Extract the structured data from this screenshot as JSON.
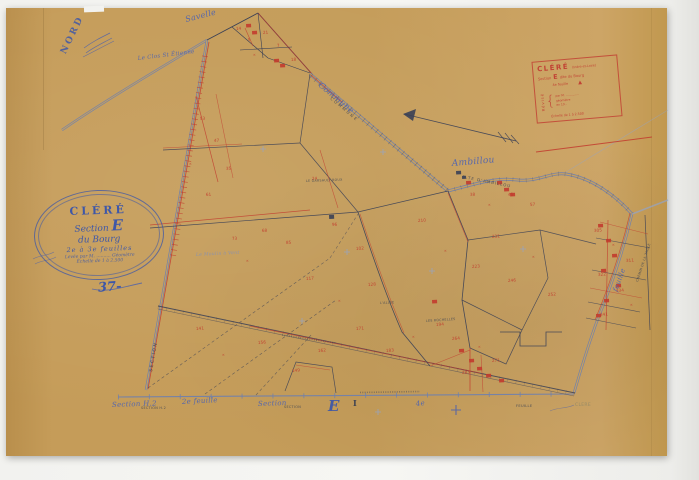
{
  "document": {
    "type": "cadastral-plan-scan",
    "commune": "CLÉRÉ",
    "section": "E"
  },
  "palette": {
    "paper": "#c9a15e",
    "blue": "#6e80ae",
    "blue_light": "#93a4c8",
    "ink": "#3a4056",
    "red": "#c23b2e",
    "stampblue": "#4a5fae",
    "label_script": "#5064b0",
    "label_caps": "#3a4254",
    "faded": "#8a8466"
  },
  "stamps": {
    "nord": {
      "label": "NORD"
    },
    "oval": {
      "title": "CLÉRÉ",
      "section_word": "Section",
      "section_letter": "E",
      "line3": "du Bourg",
      "line4": "2e à 3e feuilles",
      "line5": "Levée par M. .......... Géomètre",
      "line6": "Échelle de 1 à 2.500",
      "number": "37-"
    },
    "red_box": {
      "title": "CLÉRÉ",
      "subtitle": "(Indre-et-Loire)",
      "section_word": "Section",
      "section_letter": "E",
      "section_suffix": "dite du Bourg",
      "sheet_line": "4e feuille",
      "triangle": "▲",
      "left_word": "Révisé",
      "r1": "par M. ..............",
      "r2": "géomètre",
      "r3": "en 19..",
      "bottom": "Échelle de 1 à 2.500"
    }
  },
  "map_labels": [
    {
      "t": "Savelle",
      "x": 186,
      "y": 22,
      "r": -14,
      "s": 8,
      "cls": "script"
    },
    {
      "t": "Le Clos St Étienne",
      "x": 138,
      "y": 60,
      "r": -7,
      "s": 5.5,
      "cls": "script"
    },
    {
      "t": "Commune",
      "x": 318,
      "y": 86,
      "r": 40,
      "s": 8,
      "cls": "script"
    },
    {
      "t": "COMMUNE",
      "x": 330,
      "y": 99,
      "r": 40,
      "s": 4,
      "cls": "caps",
      "ls": 2
    },
    {
      "t": "Ambillou",
      "x": 452,
      "y": 166,
      "r": -5,
      "s": 9,
      "cls": "script"
    },
    {
      "t": "R.TE D'AMBILLOU",
      "x": 462,
      "y": 178,
      "r": 11,
      "s": 4,
      "cls": "caps",
      "ls": 1
    },
    {
      "t": "feuille",
      "x": 617,
      "y": 292,
      "r": -70,
      "s": 7,
      "cls": "script"
    },
    {
      "t": "CHEMIN DE LA TAILLE",
      "x": 638,
      "y": 282,
      "r": -72,
      "s": 3.2,
      "cls": "caps"
    },
    {
      "t": "SECTION",
      "x": 152,
      "y": 372,
      "r": -80,
      "s": 4.5,
      "cls": "caps",
      "ls": 1.5
    },
    {
      "t": "Section H.2",
      "x": 112,
      "y": 407,
      "r": -2,
      "s": 7,
      "cls": "script"
    },
    {
      "t": "SECTION H.2",
      "x": 141,
      "y": 409,
      "r": 0,
      "s": 3.4,
      "cls": "caps"
    },
    {
      "t": "2e feuille",
      "x": 182,
      "y": 404,
      "r": -3,
      "s": 7,
      "cls": "script"
    },
    {
      "t": "Section",
      "x": 258,
      "y": 406,
      "r": -2,
      "s": 7,
      "cls": "script"
    },
    {
      "t": "SECTION",
      "x": 284,
      "y": 408,
      "r": 0,
      "s": 3.4,
      "cls": "caps"
    },
    {
      "t": "E",
      "x": 328,
      "y": 411,
      "r": 0,
      "s": 15,
      "cls": "bigblue"
    },
    {
      "t": "I",
      "x": 353,
      "y": 406,
      "r": 0,
      "s": 8,
      "cls": "darkserif"
    },
    {
      "t": "4e",
      "x": 416,
      "y": 406,
      "r": -6,
      "s": 7,
      "cls": "script"
    },
    {
      "t": "FEUILLE",
      "x": 516,
      "y": 407,
      "r": 0,
      "s": 3.6,
      "cls": "caps"
    },
    {
      "t": "CLERE",
      "x": 575,
      "y": 406,
      "r": 0,
      "s": 4.5,
      "cls": "capsfaded"
    },
    {
      "t": "LE GARSAULT ROUX",
      "x": 306,
      "y": 182,
      "r": -2,
      "s": 3.2,
      "cls": "caps"
    },
    {
      "t": "Le Moulin à Vent",
      "x": 196,
      "y": 256,
      "r": -3,
      "s": 4.5,
      "cls": "scriptfaint"
    },
    {
      "t": "LES ROCHELLES",
      "x": 426,
      "y": 322,
      "r": -4,
      "s": 3.2,
      "cls": "caps"
    },
    {
      "t": "L'ALLÉE",
      "x": 380,
      "y": 304,
      "r": -3,
      "s": 3.2,
      "cls": "caps"
    }
  ],
  "map": {
    "strokes": [
      {
        "d": "M62,130 C100,104 150,74 207,40",
        "c": "blue",
        "w": 2.4,
        "o": 0.9
      },
      {
        "d": "M62,130 C100,104 150,74 207,40",
        "c": "paper",
        "w": 1
      },
      {
        "d": "M207,40 L146,390",
        "c": "blue",
        "w": 2.4,
        "o": 0.95
      },
      {
        "d": "M207,40 L146,390",
        "c": "paper",
        "w": 1
      },
      {
        "d": "M209,42 L148,389",
        "c": "red",
        "w": 0.8,
        "o": 0.85
      },
      {
        "d": "M205,56 L173,256",
        "c": "red",
        "w": 6,
        "dash": "0.7 4.6",
        "o": 0.7
      },
      {
        "d": "M207,40 L258,13",
        "c": "ink",
        "w": 0.9
      },
      {
        "d": "M258,13 L312,74",
        "c": "ink",
        "w": 0.9
      },
      {
        "d": "M258,13 L312,74",
        "c": "red",
        "w": 0.7,
        "o": 0.8
      },
      {
        "d": "M232,27 L268,58",
        "c": "ink",
        "w": 0.6
      },
      {
        "d": "M258,13 L263,58",
        "c": "ink",
        "w": 0.6
      },
      {
        "d": "M240,50 L292,47",
        "c": "ink",
        "w": 0.6
      },
      {
        "d": "M268,58 L310,73",
        "c": "ink",
        "w": 0.6
      },
      {
        "d": "M245,28 L253,46",
        "c": "red",
        "w": 0.6,
        "o": 0.8
      },
      {
        "d": "M310,74 L448,191",
        "c": "blue",
        "w": 3.2,
        "o": 0.85
      },
      {
        "d": "M310,74 L448,191",
        "c": "paper",
        "w": 1.5
      },
      {
        "d": "M311,76 L447,190",
        "c": "ink",
        "w": 5,
        "dash": "0.7 5",
        "o": 0.4
      },
      {
        "d": "M311,75 L342,102",
        "c": "red",
        "w": 0.8,
        "o": 0.8
      },
      {
        "d": "M448,191 C475,184 495,177 518,180 C538,182 550,172 566,174 C592,178 616,196 632,214",
        "c": "blue",
        "w": 3,
        "o": 0.9
      },
      {
        "d": "M448,191 C475,184 495,177 518,180 C538,182 550,172 566,174 C592,178 616,196 632,214",
        "c": "paper",
        "w": 1.3
      },
      {
        "d": "M448,191 C475,184 495,177 518,180 C538,182 550,172 566,174 C592,178 616,196 632,214",
        "c": "ink",
        "w": 4.6,
        "dash": "0.6 6",
        "o": 0.3
      },
      {
        "d": "M632,214 C623,252 611,287 597,321 C589,343 581,369 574,393",
        "c": "blue",
        "w": 2.6,
        "o": 0.9
      },
      {
        "d": "M632,214 C623,252 611,287 597,321 C589,343 581,369 574,393",
        "c": "paper",
        "w": 1.1
      },
      {
        "d": "M630,213 C621,251 609,286 595,320",
        "c": "red",
        "w": 0.7,
        "o": 0.7
      },
      {
        "d": "M632,214 L668,200",
        "c": "blue_light",
        "w": 1.6,
        "o": 0.7
      },
      {
        "d": "M566,172 L668,110",
        "c": "blue_light",
        "w": 0.7,
        "o": 0.55
      },
      {
        "d": "M118,397 L574,394",
        "c": "blue",
        "w": 1.1,
        "o": 0.9
      },
      {
        "d": "M118,397 L574,394",
        "c": "blue",
        "w": 5,
        "dash": "0.9 30",
        "o": 0.8
      },
      {
        "d": "M158,306 L575,393",
        "c": "ink",
        "w": 0.9,
        "o": 0.85
      },
      {
        "d": "M158,309 L574,396",
        "c": "ink",
        "w": 0.6,
        "o": 0.6
      },
      {
        "d": "M250,326 L480,373",
        "c": "red",
        "w": 0.8,
        "o": 0.75
      },
      {
        "d": "M158,307 L575,394",
        "c": "ink",
        "w": 3.6,
        "dash": "0.5 8",
        "o": 0.3
      },
      {
        "d": "M150,228 L358,212",
        "c": "ink",
        "w": 0.7,
        "o": 0.9
      },
      {
        "d": "M150,225 L310,210",
        "c": "red",
        "w": 0.7,
        "o": 0.8
      },
      {
        "d": "M358,212 L448,191",
        "c": "ink",
        "w": 0.7,
        "o": 0.9
      },
      {
        "d": "M358,212 C372,255 388,300 402,332 L430,366",
        "c": "ink",
        "w": 0.8,
        "o": 0.9
      },
      {
        "d": "M360,214 C374,256 390,300 404,333",
        "c": "red",
        "w": 0.6,
        "o": 0.65
      },
      {
        "d": "M163,150 L300,143",
        "c": "ink",
        "w": 0.7,
        "o": 0.85
      },
      {
        "d": "M163,148 L242,144",
        "c": "red",
        "w": 0.6,
        "o": 0.75
      },
      {
        "d": "M300,143 L310,74",
        "c": "ink",
        "w": 0.7,
        "o": 0.85
      },
      {
        "d": "M300,143 L358,212",
        "c": "ink",
        "w": 0.7,
        "o": 0.85
      },
      {
        "d": "M196,96 L218,182",
        "c": "red",
        "w": 0.7,
        "o": 0.8
      },
      {
        "d": "M216,94 L233,178",
        "c": "red",
        "w": 0.6,
        "o": 0.65
      },
      {
        "d": "M320,150 L338,208",
        "c": "red",
        "w": 0.6,
        "o": 0.7
      },
      {
        "d": "M448,191 L468,240 L462,300 L470,348",
        "c": "ink",
        "w": 0.8,
        "o": 0.9
      },
      {
        "d": "M448,193 L468,242",
        "c": "red",
        "w": 0.6,
        "o": 0.7
      },
      {
        "d": "M468,240 L540,230",
        "c": "ink",
        "w": 0.7,
        "o": 0.85
      },
      {
        "d": "M540,230 L548,278 L522,330",
        "c": "ink",
        "w": 0.7,
        "o": 0.85
      },
      {
        "d": "M462,300 L522,330",
        "c": "ink",
        "w": 0.7,
        "o": 0.85
      },
      {
        "d": "M522,330 L506,364 L470,348",
        "c": "ink",
        "w": 0.7,
        "o": 0.85
      },
      {
        "d": "M540,230 L596,244",
        "c": "ink",
        "w": 0.7,
        "o": 0.8
      },
      {
        "d": "M500,332 L520,332 L520,346 L546,346 L546,332 L562,332",
        "c": "ink",
        "w": 0.8,
        "o": 0.9
      },
      {
        "d": "M430,366 L470,350",
        "c": "red",
        "w": 0.6,
        "o": 0.7
      },
      {
        "d": "M470,348 L470,391",
        "c": "red",
        "w": 0.8,
        "o": 0.85
      },
      {
        "d": "M481,355 L483,392",
        "c": "red",
        "w": 0.6,
        "o": 0.7
      },
      {
        "d": "M285,391 L296,362 L332,367 L336,393",
        "c": "ink",
        "w": 0.7,
        "o": 0.85
      },
      {
        "d": "M296,365 L330,370",
        "c": "red",
        "w": 0.6,
        "o": 0.7
      },
      {
        "d": "M645,215 L650,330",
        "c": "ink",
        "w": 0.7,
        "o": 0.85
      },
      {
        "d": "M596,238 L650,248",
        "c": "ink",
        "w": 0.6,
        "o": 0.8
      },
      {
        "d": "M592,270 L646,280",
        "c": "ink",
        "w": 0.6,
        "o": 0.8
      },
      {
        "d": "M588,302 L640,312",
        "c": "ink",
        "w": 0.6,
        "o": 0.8
      },
      {
        "d": "M586,318 L636,328",
        "c": "ink",
        "w": 0.6,
        "o": 0.8
      },
      {
        "d": "M608,220 L606,330",
        "c": "red",
        "w": 0.7,
        "o": 0.8
      },
      {
        "d": "M600,222 L648,234",
        "c": "red",
        "w": 0.5,
        "o": 0.7
      },
      {
        "d": "M590,288 L642,298",
        "c": "red",
        "w": 0.5,
        "o": 0.7
      },
      {
        "d": "M536,152 L652,137",
        "c": "red",
        "w": 1,
        "o": 0.85
      },
      {
        "d": "M148,388 L330,258",
        "c": "ink",
        "w": 0.6,
        "dash": "3 2.6",
        "o": 0.7
      },
      {
        "d": "M205,394 L336,300",
        "c": "ink",
        "w": 0.6,
        "dash": "3 2.6",
        "o": 0.7
      },
      {
        "d": "M256,395 L312,334",
        "c": "ink",
        "w": 0.6,
        "dash": "3 2.6",
        "o": 0.65
      },
      {
        "d": "M330,258 L358,214",
        "c": "ink",
        "w": 0.6,
        "dash": "3 2.6",
        "o": 0.6
      },
      {
        "d": "M404,114 L516,141",
        "c": "ink",
        "w": 0.8,
        "o": 0.9
      },
      {
        "d": "M498,132 L506,142",
        "c": "ink",
        "w": 0.7,
        "o": 0.85
      },
      {
        "d": "M505,133 L513,143",
        "c": "ink",
        "w": 0.7,
        "o": 0.85
      },
      {
        "d": "M511,135 L519,144",
        "c": "ink",
        "w": 0.7,
        "o": 0.85
      },
      {
        "d": "M84,48 C92,42 100,38 110,33",
        "c": "stampblue",
        "w": 0.7,
        "o": 0.8
      },
      {
        "d": "M86,53 C94,47 103,43 112,38",
        "c": "stampblue",
        "w": 0.7,
        "o": 0.8
      },
      {
        "d": "M83,57 L114,41",
        "c": "stampblue",
        "w": 0.6,
        "o": 0.75
      },
      {
        "d": "M33,259 C40,255 47,256 54,252",
        "c": "stampblue",
        "w": 0.6,
        "o": 0.7
      },
      {
        "d": "M35,264 C42,260 49,261 56,257",
        "c": "stampblue",
        "w": 0.6,
        "o": 0.7
      },
      {
        "d": "M92,289 C108,293 126,286 142,283",
        "c": "stampblue",
        "w": 0.9,
        "o": 0.8
      },
      {
        "d": "M550,411 C558,407 566,409 574,405",
        "c": "stampblue",
        "w": 0.6,
        "o": 0.6
      },
      {
        "d": "M360,392.5 L420,391.5",
        "c": "ink",
        "w": 1.6,
        "dash": "1 1.3",
        "o": 0.45
      },
      {
        "d": "M282,335 L336,343",
        "c": "ink",
        "w": 1.5,
        "dash": "1 1.3",
        "o": 0.45
      }
    ],
    "polygons": [
      {
        "pts": "403,114 416,109 413,121",
        "c": "ink",
        "o": 0.9
      }
    ],
    "buildings": [
      {
        "x": 246,
        "y": 24
      },
      {
        "x": 252,
        "y": 31
      },
      {
        "x": 274,
        "y": 59
      },
      {
        "x": 280,
        "y": 64
      },
      {
        "x": 466,
        "y": 181
      },
      {
        "x": 497,
        "y": 181
      },
      {
        "x": 504,
        "y": 188
      },
      {
        "x": 510,
        "y": 193
      },
      {
        "x": 598,
        "y": 224
      },
      {
        "x": 606,
        "y": 239
      },
      {
        "x": 612,
        "y": 254
      },
      {
        "x": 601,
        "y": 269
      },
      {
        "x": 616,
        "y": 284
      },
      {
        "x": 604,
        "y": 299
      },
      {
        "x": 596,
        "y": 314
      },
      {
        "x": 459,
        "y": 349
      },
      {
        "x": 469,
        "y": 359
      },
      {
        "x": 477,
        "y": 367
      },
      {
        "x": 486,
        "y": 374
      },
      {
        "x": 499,
        "y": 379
      },
      {
        "x": 432,
        "y": 300
      },
      {
        "x": 329,
        "y": 215,
        "w": 5,
        "h": 4,
        "f": "ink"
      },
      {
        "x": 456,
        "y": 171,
        "f": "ink"
      },
      {
        "x": 462,
        "y": 176,
        "w": 4,
        "h": 3,
        "f": "ink"
      }
    ],
    "crosses": [
      {
        "x": 263,
        "y": 149,
        "s": 3
      },
      {
        "x": 347,
        "y": 252,
        "s": 3
      },
      {
        "x": 302,
        "y": 321,
        "s": 3
      },
      {
        "x": 432,
        "y": 271,
        "s": 3
      },
      {
        "x": 523,
        "y": 249,
        "s": 3
      },
      {
        "x": 383,
        "y": 152,
        "s": 3
      },
      {
        "x": 378,
        "y": 412,
        "s": 3
      },
      {
        "x": 456,
        "y": 410,
        "s": 5,
        "c": "stampblue",
        "w": 1.1
      }
    ],
    "parcel_numbers": [
      {
        "x": 236,
        "y": 30,
        "t": "14"
      },
      {
        "x": 248,
        "y": 41,
        "t": "9"
      },
      {
        "x": 263,
        "y": 34,
        "t": "21"
      },
      {
        "x": 277,
        "y": 47,
        "t": "7"
      },
      {
        "x": 291,
        "y": 61,
        "t": "18"
      },
      {
        "x": 253,
        "y": 56,
        "t": "×"
      },
      {
        "x": 200,
        "y": 120,
        "t": "53"
      },
      {
        "x": 214,
        "y": 142,
        "t": "47"
      },
      {
        "x": 189,
        "y": 165,
        "t": "×"
      },
      {
        "x": 226,
        "y": 170,
        "t": "35"
      },
      {
        "x": 206,
        "y": 196,
        "t": "61"
      },
      {
        "x": 232,
        "y": 240,
        "t": "73"
      },
      {
        "x": 262,
        "y": 232,
        "t": "68"
      },
      {
        "x": 246,
        "y": 262,
        "t": "×"
      },
      {
        "x": 286,
        "y": 244,
        "t": "85"
      },
      {
        "x": 312,
        "y": 180,
        "t": "24"
      },
      {
        "x": 332,
        "y": 226,
        "t": "96"
      },
      {
        "x": 356,
        "y": 250,
        "t": "102"
      },
      {
        "x": 306,
        "y": 280,
        "t": "117"
      },
      {
        "x": 338,
        "y": 302,
        "t": "×"
      },
      {
        "x": 368,
        "y": 286,
        "t": "128"
      },
      {
        "x": 196,
        "y": 330,
        "t": "141"
      },
      {
        "x": 222,
        "y": 356,
        "t": "×"
      },
      {
        "x": 258,
        "y": 344,
        "t": "156"
      },
      {
        "x": 292,
        "y": 372,
        "t": "149"
      },
      {
        "x": 318,
        "y": 352,
        "t": "162"
      },
      {
        "x": 356,
        "y": 330,
        "t": "171"
      },
      {
        "x": 386,
        "y": 352,
        "t": "183"
      },
      {
        "x": 412,
        "y": 338,
        "t": "×"
      },
      {
        "x": 436,
        "y": 326,
        "t": "194"
      },
      {
        "x": 418,
        "y": 222,
        "t": "210"
      },
      {
        "x": 444,
        "y": 252,
        "t": "×"
      },
      {
        "x": 472,
        "y": 268,
        "t": "223"
      },
      {
        "x": 492,
        "y": 238,
        "t": "231"
      },
      {
        "x": 508,
        "y": 282,
        "t": "246"
      },
      {
        "x": 532,
        "y": 258,
        "t": "×"
      },
      {
        "x": 548,
        "y": 296,
        "t": "252"
      },
      {
        "x": 452,
        "y": 340,
        "t": "264"
      },
      {
        "x": 478,
        "y": 348,
        "t": "×"
      },
      {
        "x": 492,
        "y": 362,
        "t": "271"
      },
      {
        "x": 462,
        "y": 374,
        "t": "283"
      },
      {
        "x": 594,
        "y": 232,
        "t": "305"
      },
      {
        "x": 612,
        "y": 246,
        "t": "×"
      },
      {
        "x": 626,
        "y": 262,
        "t": "311"
      },
      {
        "x": 598,
        "y": 276,
        "t": "322"
      },
      {
        "x": 616,
        "y": 292,
        "t": "334"
      },
      {
        "x": 630,
        "y": 306,
        "t": "×"
      },
      {
        "x": 600,
        "y": 316,
        "t": "341"
      },
      {
        "x": 470,
        "y": 196,
        "t": "38"
      },
      {
        "x": 488,
        "y": 206,
        "t": "×"
      },
      {
        "x": 508,
        "y": 196,
        "t": "45"
      },
      {
        "x": 530,
        "y": 206,
        "t": "57"
      }
    ]
  }
}
